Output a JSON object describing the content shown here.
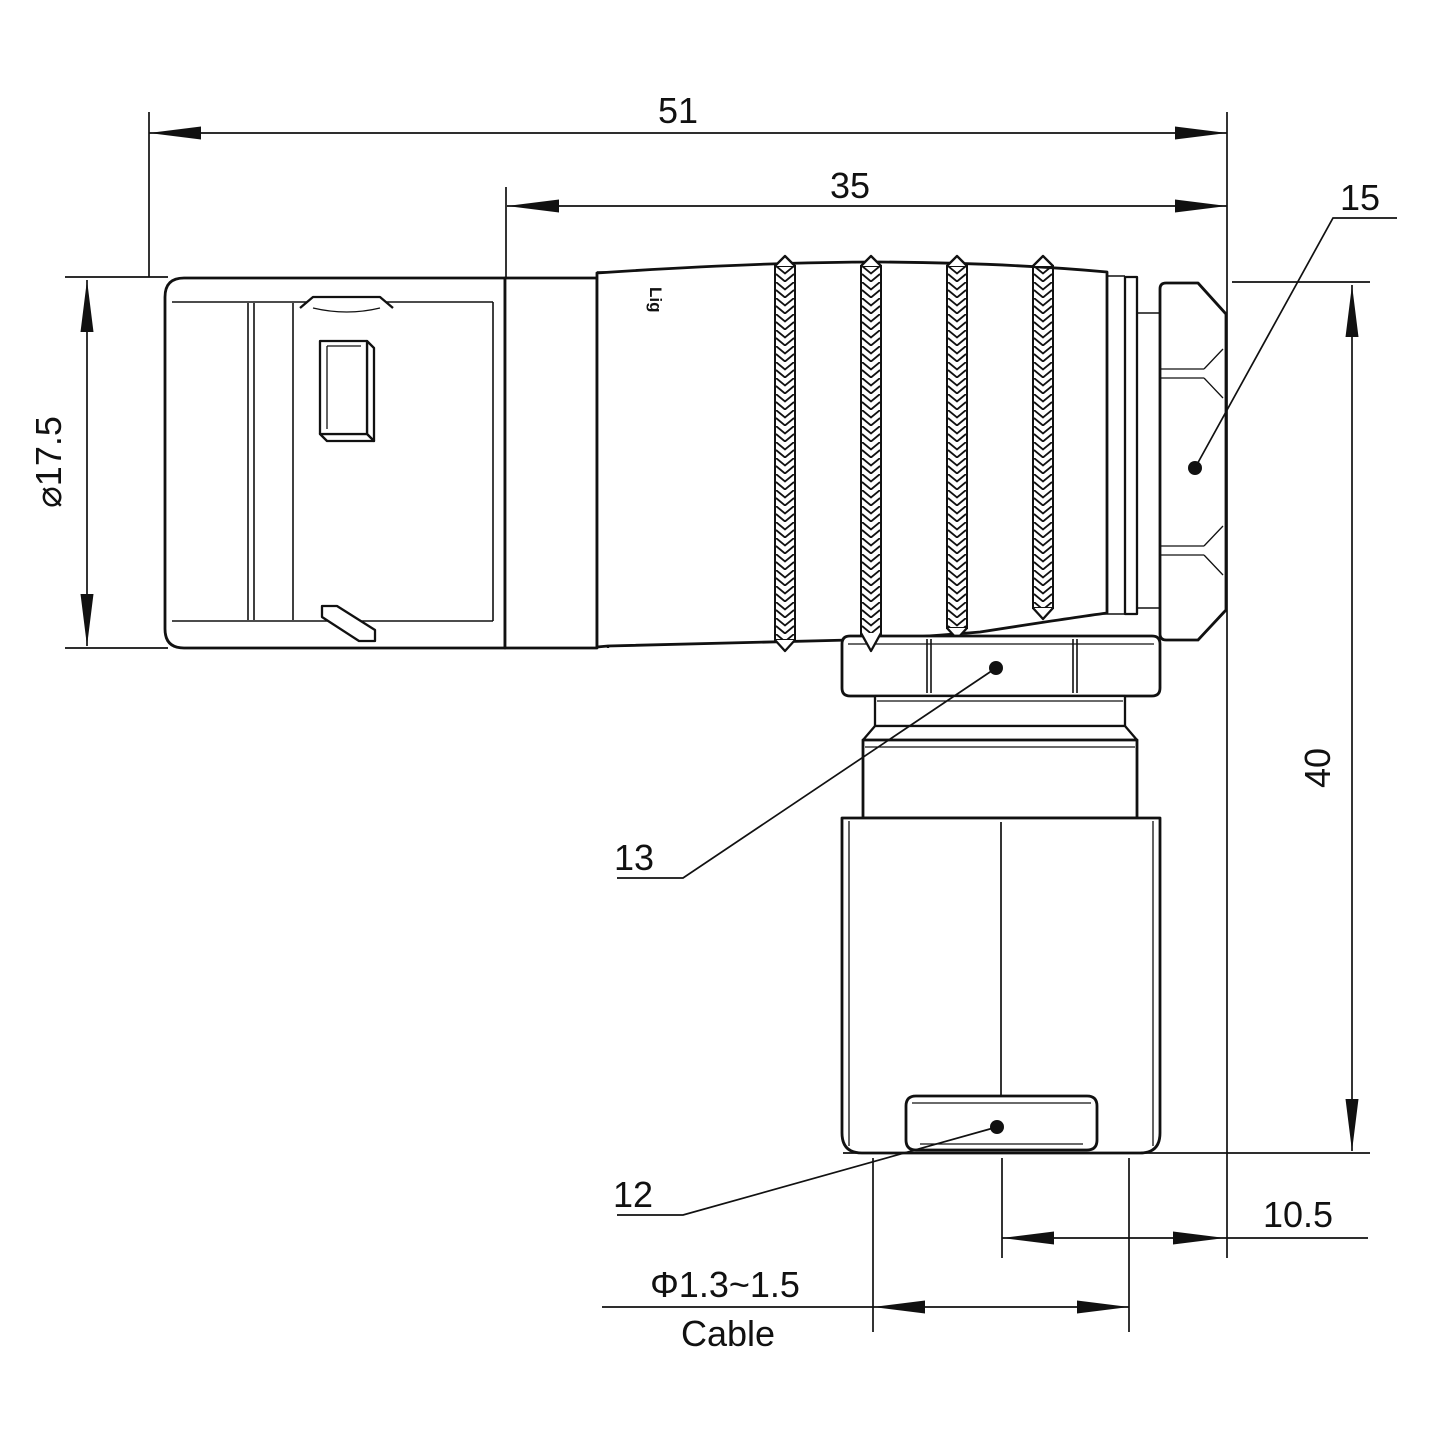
{
  "drawing": {
    "watermark": "Lightany",
    "body_mark": "Lig",
    "labels": {
      "overall_length": "51",
      "grip_length": "35",
      "backnut_ref": "15",
      "diameter": "⌀17.5",
      "height": "40",
      "coupling_ref": "13",
      "clamp_ref": "12",
      "offset": "10.5",
      "cable_diameter": "Φ1.3~1.5",
      "cable": "Cable"
    },
    "colors": {
      "line": "#111111",
      "watermark": "#f2baba",
      "background": "#ffffff"
    }
  }
}
